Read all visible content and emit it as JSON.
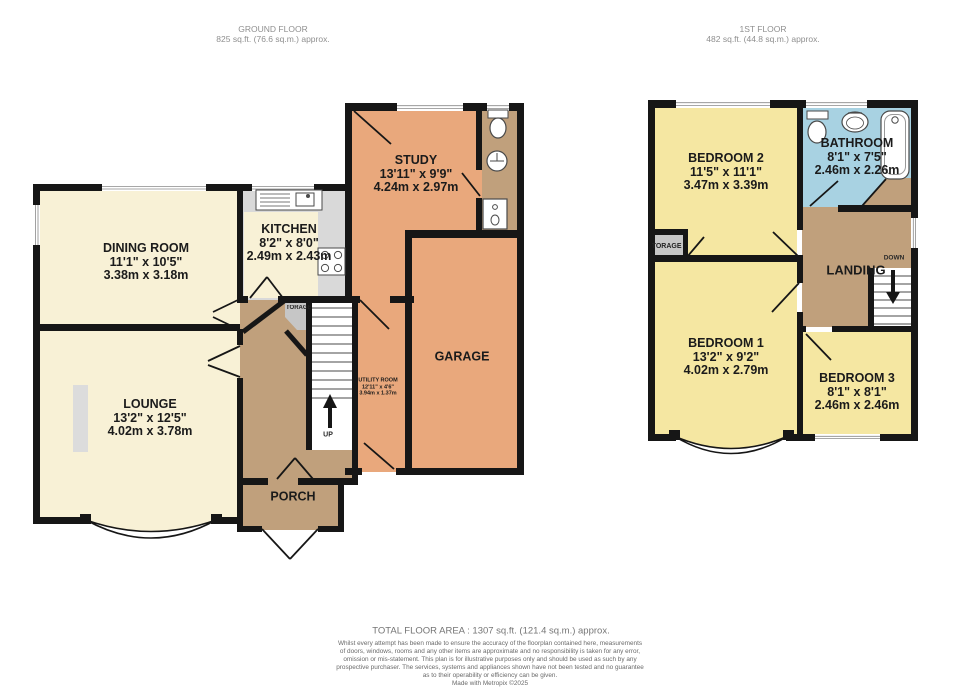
{
  "headers": {
    "ground": {
      "title": "GROUND FLOOR",
      "area": "825 sq.ft. (76.6 sq.m.) approx."
    },
    "first": {
      "title": "1ST FLOOR",
      "area": "482 sq.ft. (44.8 sq.m.) approx."
    }
  },
  "ground_floor": {
    "dining": {
      "name": "DINING ROOM",
      "imperial": "11'1\"  x 10'5\"",
      "metric": "3.38m  x 3.18m"
    },
    "lounge": {
      "name": "LOUNGE",
      "imperial": "13'2\"  x 12'5\"",
      "metric": "4.02m  x 3.78m"
    },
    "kitchen": {
      "name": "KITCHEN",
      "imperial": "8'2\"  x 8'0\"",
      "metric": "2.49m  x 2.43m"
    },
    "study": {
      "name": "STUDY",
      "imperial": "13'11\"  x 9'9\"",
      "metric": "4.24m  x 2.97m"
    },
    "utility": {
      "name": "UTILITY ROOM",
      "imperial": "12'11\"  x 4'6\"",
      "metric": "3.94m  x 1.37m"
    },
    "garage": {
      "name": "GARAGE"
    },
    "porch": {
      "name": "PORCH"
    },
    "storage": {
      "name": "STORAGE"
    },
    "up_label": "UP"
  },
  "first_floor": {
    "bedroom1": {
      "name": "BEDROOM 1",
      "imperial": "13'2\"  x 9'2\"",
      "metric": "4.02m  x 2.79m"
    },
    "bedroom2": {
      "name": "BEDROOM 2",
      "imperial": "11'5\"  x 11'1\"",
      "metric": "3.47m  x 3.39m"
    },
    "bedroom3": {
      "name": "BEDROOM 3",
      "imperial": "8'1\"  x 8'1\"",
      "metric": "2.46m  x 2.46m"
    },
    "bathroom": {
      "name": "BATHROOM",
      "imperial": "8'1\"  x 7'5\"",
      "metric": "2.46m  x 2.26m"
    },
    "landing": {
      "name": "LANDING"
    },
    "storage": {
      "name": "STORAGE"
    },
    "down_label": "DOWN"
  },
  "footer": {
    "total": "TOTAL FLOOR AREA : 1307 sq.ft. (121.4 sq.m.) approx.",
    "disclaimer_lines": [
      "Whilst every attempt has been made to ensure the accuracy of the floorplan contained here, measurements",
      "of doors, windows, rooms and any other items are approximate and no responsibility is taken for any error,",
      "omission or mis-statement. This plan is for illustrative purposes only and should be used as such by any",
      "prospective purchaser. The services, systems and appliances shown have not been tested and no guarantee",
      "as to their operability or efficiency can be given."
    ],
    "credit": "Made with Metropix ©2025"
  },
  "colors": {
    "wall": "#161616",
    "cream": "#f8f1d6",
    "yellow": "#f5e7a2",
    "orange": "#e9a87c",
    "tan": "#c0a07c",
    "blue": "#a8d2e2",
    "floor_gray": "#d9d9d9",
    "storage_gray": "#c6c6c6",
    "fixture": "#4a4a4a"
  }
}
